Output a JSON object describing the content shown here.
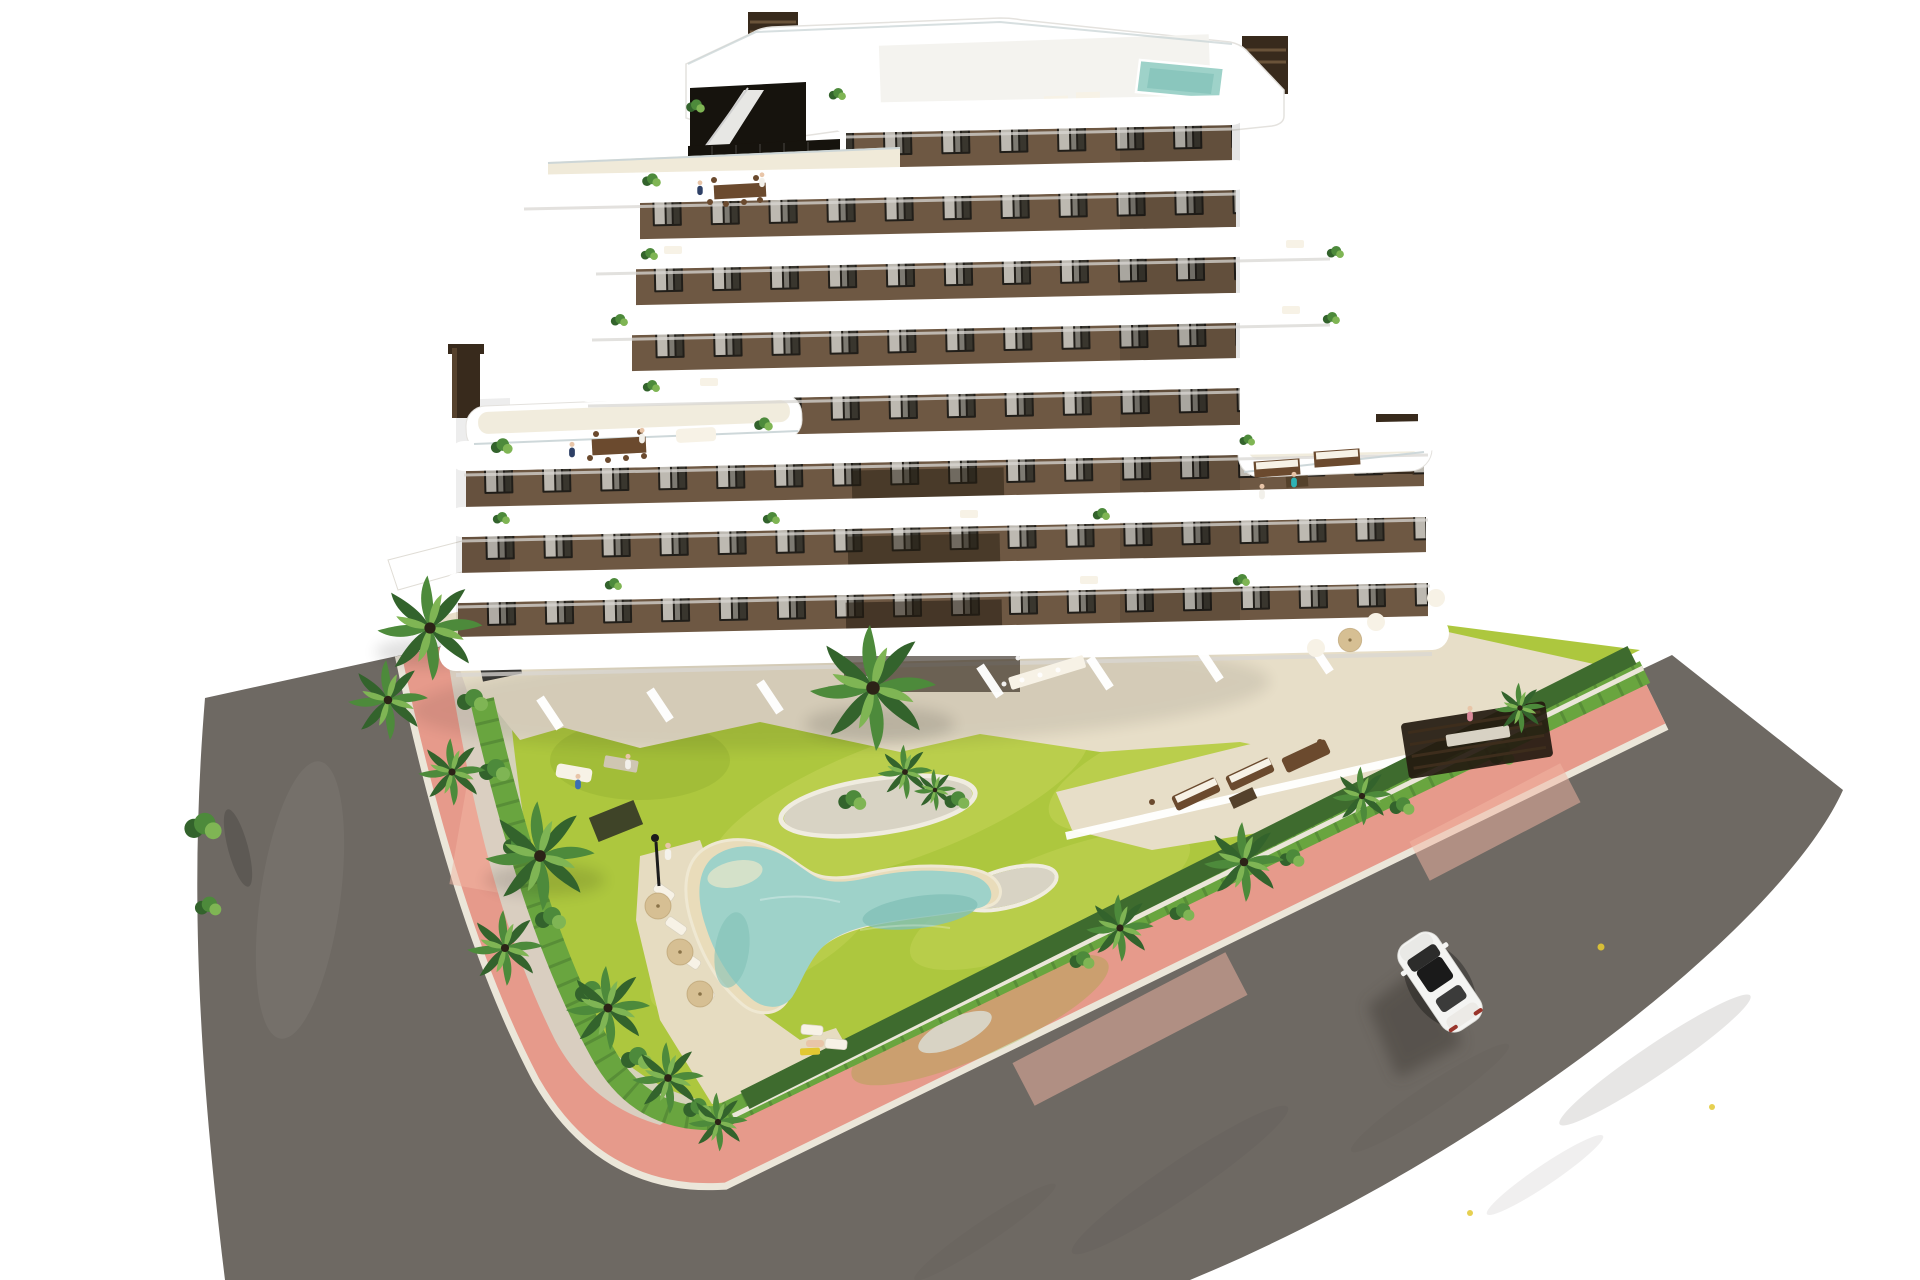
{
  "scene": {
    "type": "aerial-architectural-3d-rendering",
    "view": "high-angle aerial view on white background",
    "objects": [
      "modern apartment building with curved white balcony bands and brown stucco facade",
      "rooftop deck with plunge pool, stair bulkhead and slatted chimneys",
      "floor terraces with residents, plants and outdoor furniture",
      "landscaped garden with bright lawn and gravel planting islands",
      "free-form boomerang-shaped swimming pool with sandy beach edge",
      "sun loungers with tan parasols and a pool lamp",
      "palm trees, shrubs and perimeter hedges",
      "pink paved perimeter sidewalk with pale curbs",
      "dark asphalt roads on two sides",
      "white car driving on the road",
      "ground-floor private terraces with white divider walls",
      "communal dining terrace with long table and pergola"
    ]
  },
  "colors": {
    "bg": "#ffffff",
    "road": "#6e6963",
    "road_stain": "#55504a",
    "sidewalk": "#e69a8b",
    "sidewalk_light": "#f2b5a3",
    "curb": "#ebe6d9",
    "lawn": "#adc73e",
    "lawn_light": "#c9d85d",
    "lawn_dark": "#90ad2f",
    "hedge_dark": "#3e6b2e",
    "hedge_light": "#69a53f",
    "gravel": "#d8d3c4",
    "gravel_rim": "#f0ece0",
    "sand": "#e9dcba",
    "sand_deck": "#e6dcc1",
    "deck": "#e7dec8",
    "deck_light": "#f0ead9",
    "water": "#9ed2c9",
    "water_deep": "#82c1b8",
    "wall": "#6e5843",
    "window": "#211e19",
    "curtain": "#d9d5cc",
    "band": "#ffffff",
    "band_shadow": "#d9d7d3",
    "railing": "#c9d4d6",
    "chimney": "#382a1c",
    "chimney_light": "#6a5339",
    "glass_dark": "#16130d",
    "wood": "#6b4a2e",
    "wood_dark": "#54412b",
    "umbrella": "#d6bf93",
    "lounger": "#f7f2e6",
    "palm_dark": "#33632c",
    "palm_mid": "#4d8a3b",
    "palm_light": "#7fb554",
    "car_body": "#f4f4f2",
    "car_glass": "#1a1a1a",
    "car_shadow": "#433e39",
    "skin": "#e8c5a8",
    "teal": "#2fb3b5",
    "navy": "#2e4066",
    "blue": "#3a6fb3",
    "pink": "#d98a9a",
    "yellow": "#e2c832"
  }
}
